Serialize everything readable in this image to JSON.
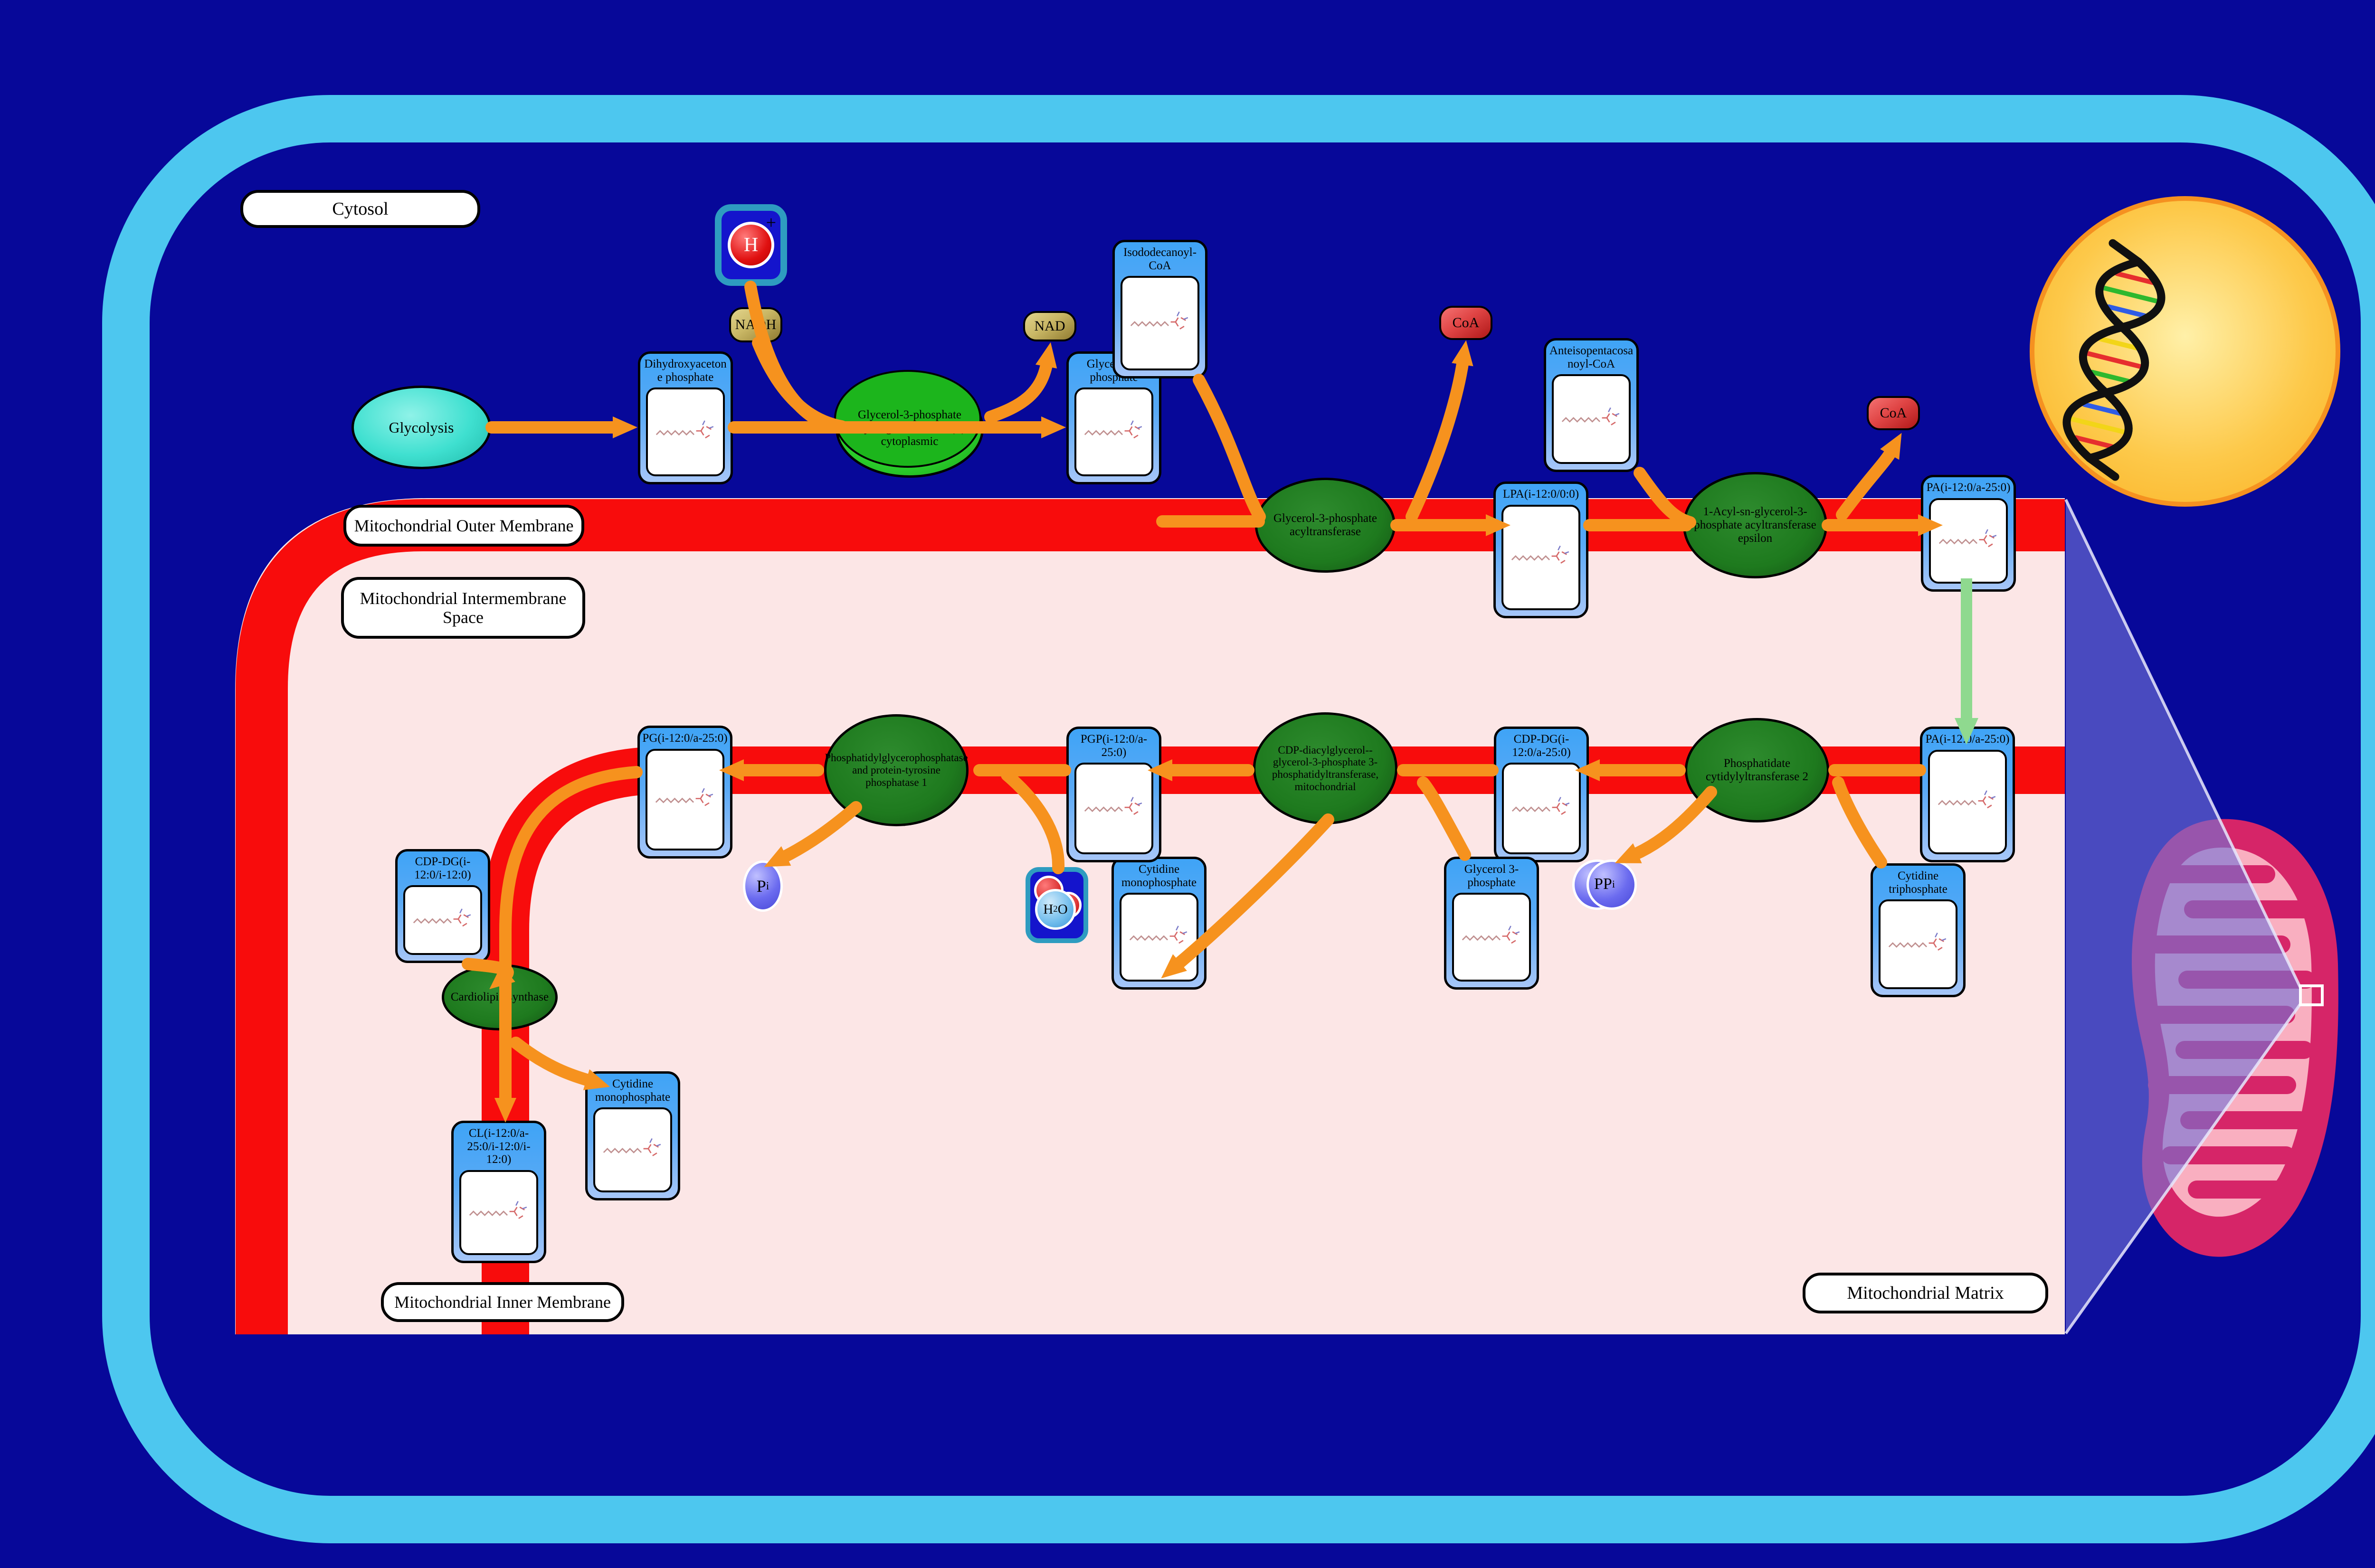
{
  "compartments": {
    "cytosol": "Cytosol",
    "outer_membrane": "Mitochondrial Outer Membrane",
    "intermembrane_space": "Mitochondrial Intermembrane Space",
    "inner_membrane": "Mitochondrial Inner Membrane",
    "matrix": "Mitochondrial Matrix"
  },
  "processes": {
    "glycolysis": "Glycolysis"
  },
  "enzymes": {
    "gpd1": "Glycerol-3-phosphate dehydrogenase [NAD(+)], cytoplasmic",
    "gpat": "Glycerol-3-phosphate acyltransferase",
    "agpat": "1-Acyl-sn-glycerol-3-phosphate acyltransferase epsilon",
    "cds2": "Phosphatidate cytidylyltransferase 2",
    "pgs1": "CDP-diacylglycerol--glycerol-3-phosphate 3-phosphatidyltransferase, mitochondrial",
    "ptpmt1": "Phosphatidylglycerophosphatase and protein-tyrosine phosphatase 1",
    "crls1": "Cardiolipin synthase"
  },
  "metabolites": {
    "dhap": "Dihydroxyacetone phosphate",
    "glycerol_3_phosphate_cytosol": "Glycerol 3-phosphate",
    "isododecanoyl_coa": "Isododecanoyl-CoA",
    "anteisopentacosanoyl_coa": "Anteisopentacosanoyl-CoA",
    "lpa": "LPA(i-12:0/0:0)",
    "pa_outer_membrane": "PA(i-12:0/a-25:0)",
    "pa_inner_membrane": "PA(i-12:0/a-25:0)",
    "cytidine_triphosphate": "Cytidine triphosphate",
    "cdp_dg": "CDP-DG(i-12:0/a-25:0)",
    "glycerol_3_phosphate_matrix": "Glycerol 3-phosphate",
    "cytidine_monophosphate_upper": "Cytidine monophosphate",
    "pgp": "PGP(i-12:0/a-25:0)",
    "pg": "PG(i-12:0/a-25:0)",
    "cdp_dg_2": "CDP-DG(i-12:0/i-12:0)",
    "cytidine_monophosphate_lower": "Cytidine monophosphate",
    "cardiolipin": "CL(i-12:0/a-25:0/i-12:0/i-12:0)"
  },
  "cofactors": {
    "nadh": "NADH",
    "nad": "NAD",
    "coa_1": "CoA",
    "coa_2": "CoA"
  },
  "ions": {
    "proton": {
      "symbol": "H",
      "charge": "+"
    },
    "water": {
      "h": "H",
      "two": "2",
      "o": "O"
    },
    "phosphate": {
      "p": "P",
      "i": "i"
    },
    "pyrophosphate": {
      "pp": "PP",
      "i": "i"
    }
  },
  "icons": {
    "dna_helix_icon": "double helix inside nucleus",
    "mitochondrion_icon": "mitochondrion with cristae",
    "zoom_wedge_icon": "zoom call-out from mitochondrion membrane detail",
    "chemical_structure_icon": "skeletal structure thumbnail"
  },
  "colors": {
    "background": "#070899",
    "cell_border": "#4DC7EF",
    "membrane_red": "#F80C0C",
    "compartment_pink": "#FCE6E6",
    "arrow_orange": "#F6921E",
    "transport_green": "#8FD98F",
    "metabolite_header_blue": "#3FA4F6",
    "metabolite_body_blue": "#A6C6F8",
    "enzyme_dark_green": "#1E7A1E",
    "enzyme_bright_green": "#2ED42E",
    "process_turquoise": "#3FE0D0",
    "nucleus_yellow": "#FDC332",
    "mito_crimson": "#D62568",
    "mito_pink": "#F9AFC0",
    "wedge_purple": "#7373D6",
    "cofactor_khaki": "#C9B765",
    "coa_red": "#E04545",
    "ion_blue": "#1414CC",
    "ion_border_teal": "#2E9CC0",
    "phosphate_purple": "#6B6BEF"
  }
}
